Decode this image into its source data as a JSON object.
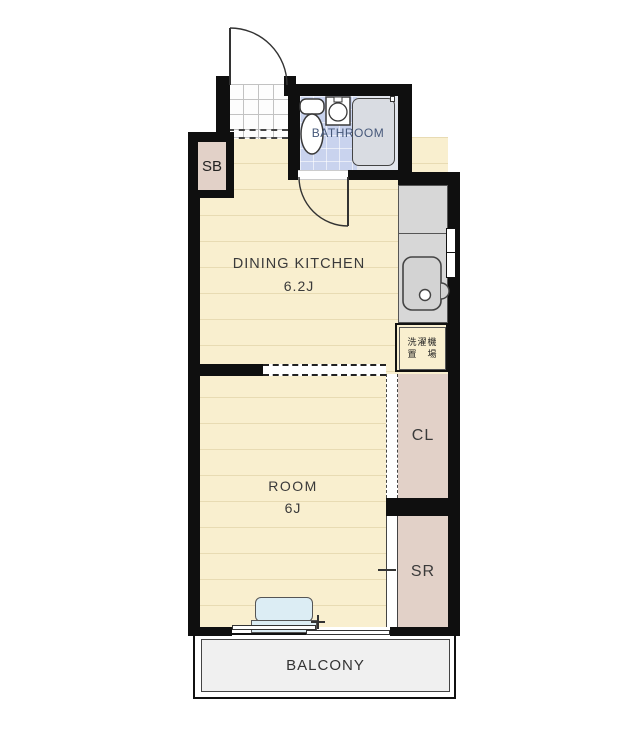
{
  "title": "1DK apartment floor plan",
  "rooms": {
    "bathroom": {
      "label": "BATHROOM"
    },
    "dining_kitchen": {
      "label": "DINING KITCHEN",
      "size": "6.2J"
    },
    "room": {
      "label": "ROOM",
      "size": "6J"
    },
    "closet": {
      "label": "CL"
    },
    "service_room": {
      "label": "SR"
    },
    "shoe_box": {
      "label": "SB"
    },
    "balcony": {
      "label": "BALCONY"
    },
    "washer_area": {
      "line1": "洗濯機",
      "line2": "置　場"
    }
  },
  "colors": {
    "wall": "#0f0f0f",
    "floor_cream": "#f9efcf",
    "floor_stripe": "#e8dbb3",
    "bath_tile_blue": "#c9d3ee",
    "bath_zone_gray": "#e2e5ec",
    "closet_pink": "#e2d1c8",
    "counter_gray": "#d7d7d7",
    "balcony_gray": "#f0f0f0",
    "furniture_blue": "#dcedf4",
    "label_text": "#3a3a3a",
    "bathroom_text": "#46587a"
  }
}
